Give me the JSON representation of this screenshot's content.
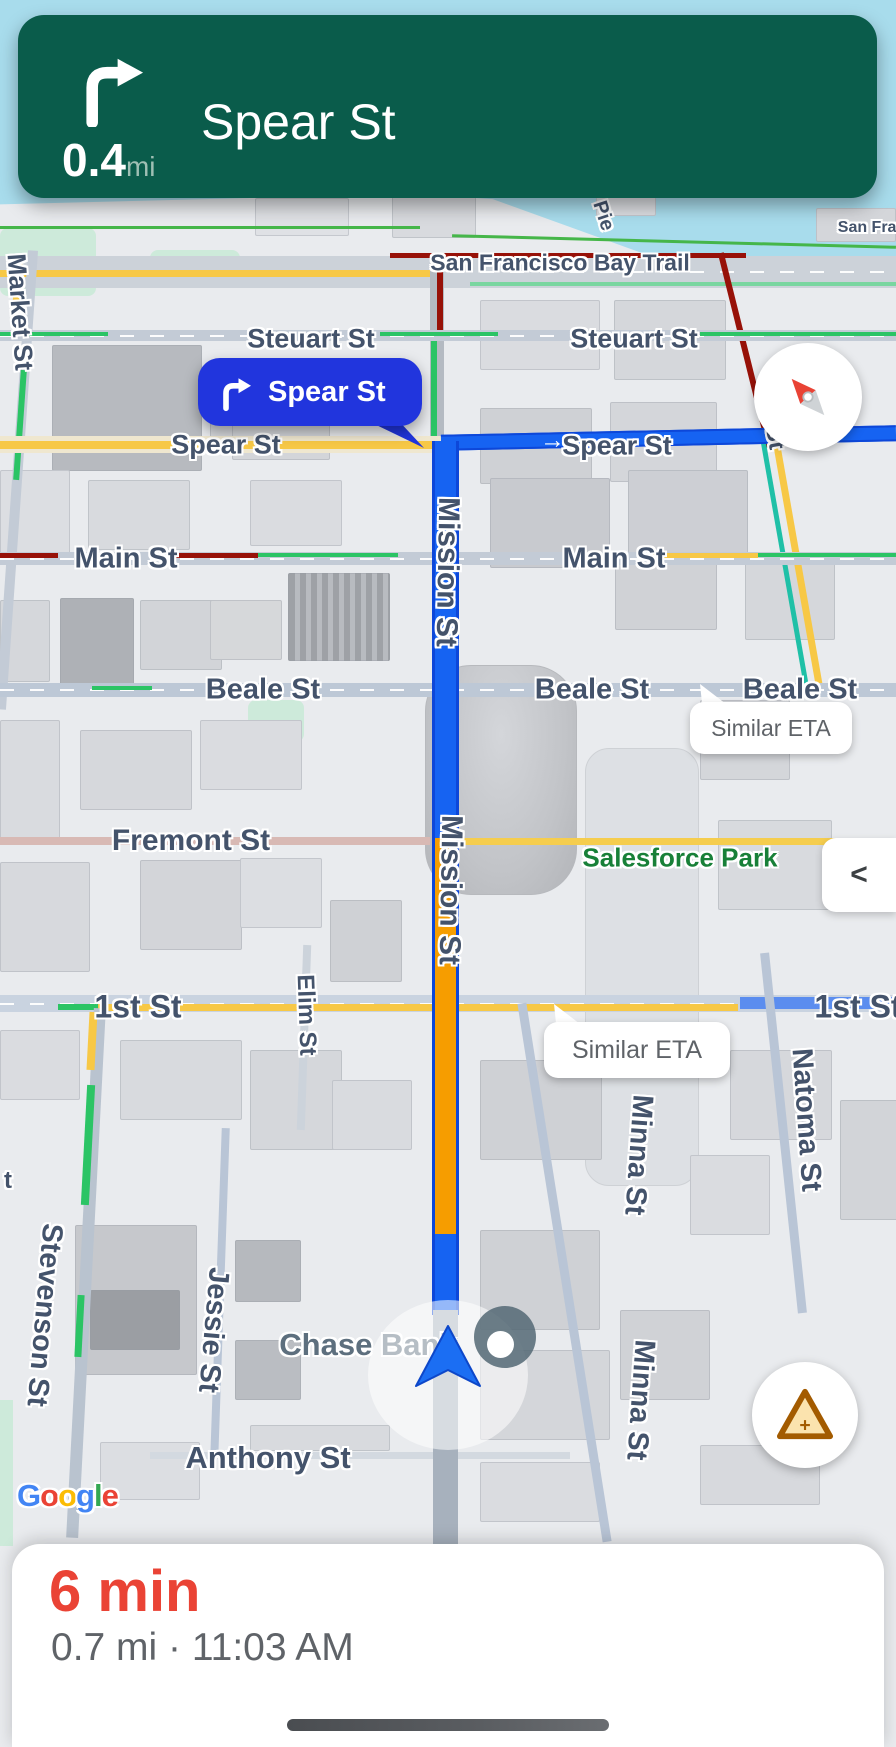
{
  "banner": {
    "bg_color": "#0a5c4b",
    "maneuver": "turn-right",
    "distance": "0.4",
    "distance_unit": "mi",
    "street": "Spear St"
  },
  "panel": {
    "eta": "6 min",
    "eta_color": "#EA4335",
    "details": "0.7 mi · 11:03 AM"
  },
  "callout": {
    "label": "Spear St",
    "bg_color": "#2135dd"
  },
  "eta_bubbles": [
    {
      "text": "Similar ETA",
      "x": 690,
      "y": 702,
      "w": 162,
      "h": 52,
      "fs": 23
    },
    {
      "text": "Similar ETA",
      "x": 544,
      "y": 1022,
      "w": 186,
      "h": 56,
      "fs": 25
    }
  ],
  "controls": {
    "collapse": "<"
  },
  "route": {
    "blue": "#1663f2",
    "traffic_orange": "#f69d00"
  },
  "street_labels": [
    {
      "text": "San Francisco Bay Trail",
      "x": 560,
      "y": 263,
      "rot": 0,
      "fs": 23
    },
    {
      "text": "San Fran",
      "x": 872,
      "y": 228,
      "rot": 0,
      "fs": 16
    },
    {
      "text": "Pie",
      "x": 603,
      "y": 216,
      "rot": 72,
      "fs": 20
    },
    {
      "text": "Market St",
      "x": 20,
      "y": 312,
      "rot": 86,
      "fs": 26
    },
    {
      "text": "Steuart St",
      "x": 311,
      "y": 339,
      "rot": 0,
      "fs": 27
    },
    {
      "text": "Steuart St",
      "x": 634,
      "y": 339,
      "rot": 0,
      "fs": 27
    },
    {
      "text": "Spear St",
      "x": 226,
      "y": 445,
      "rot": 0,
      "fs": 27
    },
    {
      "text": "Spear St",
      "x": 617,
      "y": 446,
      "rot": 0,
      "fs": 27
    },
    {
      "text": "d St",
      "x": 773,
      "y": 427,
      "rot": 80,
      "fs": 24
    },
    {
      "text": "Main St",
      "x": 126,
      "y": 559,
      "rot": 0,
      "fs": 29
    },
    {
      "text": "Main St",
      "x": 614,
      "y": 559,
      "rot": 0,
      "fs": 29
    },
    {
      "text": "Mission St",
      "x": 447,
      "y": 572,
      "rot": 91,
      "fs": 30
    },
    {
      "text": "Mission St",
      "x": 450,
      "y": 890,
      "rot": 91,
      "fs": 30
    },
    {
      "text": "Beale St",
      "x": 263,
      "y": 690,
      "rot": 0,
      "fs": 29
    },
    {
      "text": "Beale St",
      "x": 592,
      "y": 690,
      "rot": 0,
      "fs": 29
    },
    {
      "text": "Beale St",
      "x": 800,
      "y": 690,
      "rot": 0,
      "fs": 29
    },
    {
      "text": "Fremont St",
      "x": 191,
      "y": 841,
      "rot": 0,
      "fs": 30
    },
    {
      "text": "Salesforce Park",
      "x": 680,
      "y": 858,
      "rot": 0,
      "fs": 26,
      "color": "#188038"
    },
    {
      "text": "1st St",
      "x": 138,
      "y": 1007,
      "rot": 0,
      "fs": 32
    },
    {
      "text": "1st St",
      "x": 858,
      "y": 1007,
      "rot": 0,
      "fs": 32
    },
    {
      "text": "Elim St",
      "x": 306,
      "y": 1015,
      "rot": 88,
      "fs": 24
    },
    {
      "text": "Natoma St",
      "x": 806,
      "y": 1120,
      "rot": 86,
      "fs": 29
    },
    {
      "text": "Minna St",
      "x": 638,
      "y": 1155,
      "rot": 94,
      "fs": 29
    },
    {
      "text": "Minna St",
      "x": 640,
      "y": 1400,
      "rot": 94,
      "fs": 29
    },
    {
      "text": "Jessie St",
      "x": 213,
      "y": 1330,
      "rot": 95,
      "fs": 29
    },
    {
      "text": "Stevenson St",
      "x": 44,
      "y": 1315,
      "rot": 95,
      "fs": 29
    },
    {
      "text": "t",
      "x": 8,
      "y": 1181,
      "rot": 0,
      "fs": 24
    },
    {
      "text": "Chase Bank",
      "x": 368,
      "y": 1345,
      "rot": 0,
      "fs": 31,
      "color": "#5d6f7e"
    },
    {
      "text": "Anthony St",
      "x": 268,
      "y": 1458,
      "rot": 0,
      "fs": 31
    }
  ],
  "watermark": {
    "text": "Google",
    "letters": [
      {
        "ch": "G",
        "c": "#4285F4"
      },
      {
        "ch": "o",
        "c": "#EA4335"
      },
      {
        "ch": "o",
        "c": "#FBBC05"
      },
      {
        "ch": "g",
        "c": "#4285F4"
      },
      {
        "ch": "l",
        "c": "#34A853"
      },
      {
        "ch": "e",
        "c": "#EA4335"
      }
    ]
  }
}
